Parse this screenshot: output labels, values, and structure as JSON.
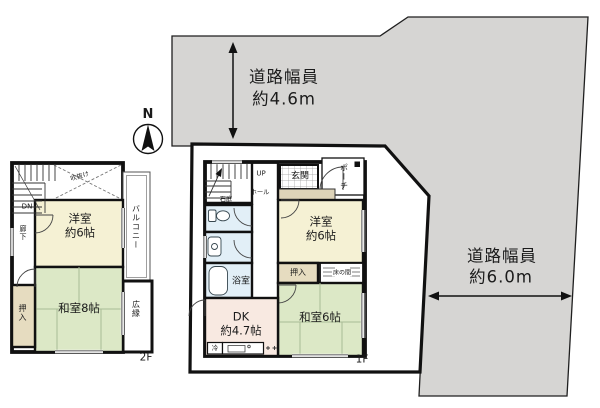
{
  "colors": {
    "road": "#d6d5d3",
    "cream": "#f5f1d4",
    "tatami": "#dce8c6",
    "closet": "#e6dcc0",
    "bath": "#e2eff7",
    "dk": "#f8e9e1",
    "step": "#ddd3b8",
    "ink": "#1a1a1a"
  },
  "compass": {
    "label": "N"
  },
  "roads": {
    "top": {
      "title": "道路幅員",
      "width": "約4.6m"
    },
    "right": {
      "title": "道路幅員",
      "width": "約6.0m"
    }
  },
  "floor2": {
    "label": "2F",
    "stair_label": "DN",
    "corridor": "廊下",
    "atrium": "吹抜け",
    "western_room": {
      "line1": "洋室",
      "line2": "約6帖"
    },
    "japanese_room": "和室8帖",
    "closet": "押入",
    "balcony": "バルコニー",
    "veranda": "広縁"
  },
  "floor1": {
    "label": "1F",
    "stair_label": "UP",
    "hall": "ホール",
    "rock_garden": "石庭",
    "entrance": "玄関",
    "porch": "ポーチ",
    "western_room": {
      "line1": "洋室",
      "line2": "約6帖"
    },
    "closet": "押入",
    "alcove": "床の間",
    "japanese_room": "和室6帖",
    "dining_kitchen": {
      "line1": "DK",
      "line2": "約4.7帖"
    },
    "bathroom": "浴室",
    "fridge": "冷"
  }
}
